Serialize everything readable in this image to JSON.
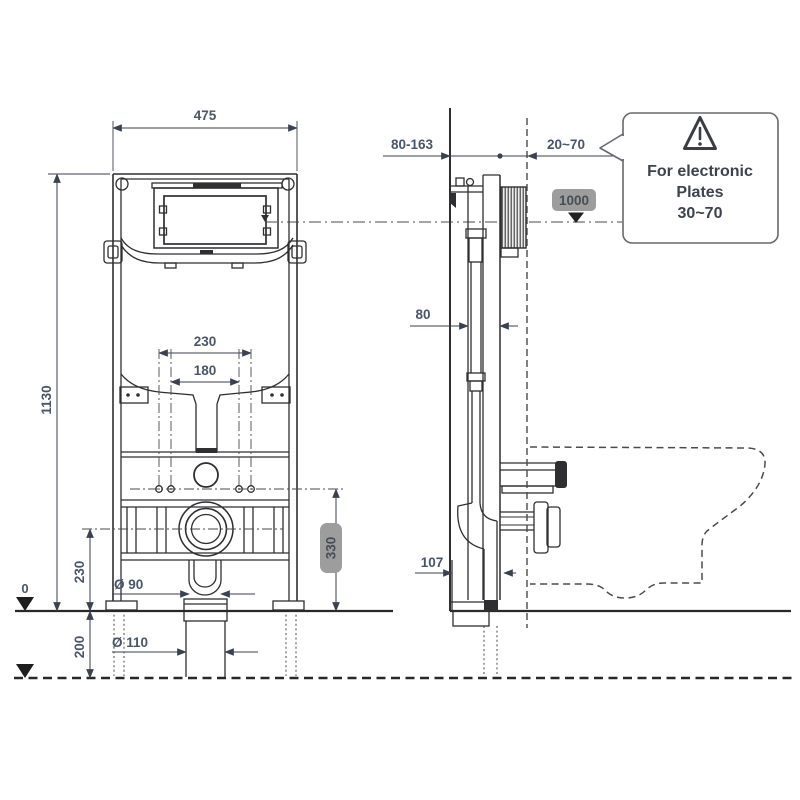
{
  "front_view": {
    "labels": {
      "width": "475",
      "height": "1130",
      "stud_spacing": "230",
      "inner_spacing": "180",
      "outlet_center_height": "230",
      "floor_datum": "0",
      "below_floor_depth": "200",
      "flush_pipe_diameter": "Ø 90",
      "drain_pipe_diameter": "Ø 110",
      "outlet_height_badge": "330"
    }
  },
  "side_view": {
    "labels": {
      "wall_to_front_range": "80-163",
      "plate_depth_range": "20~70",
      "actuation_height_badge": "1000",
      "frame_depth": "80",
      "outlet_offset": "107"
    }
  },
  "callout": {
    "icon": "warning-triangle",
    "lines": [
      "For electronic",
      "Plates",
      "30~70"
    ]
  },
  "colors": {
    "line": "#2f2f31",
    "dim_line": "#39424e",
    "dim_text": "#4a5568",
    "badge_bg": "#9d9d9d",
    "badge_text": "#474e54",
    "callout_text": "#3d434d"
  }
}
